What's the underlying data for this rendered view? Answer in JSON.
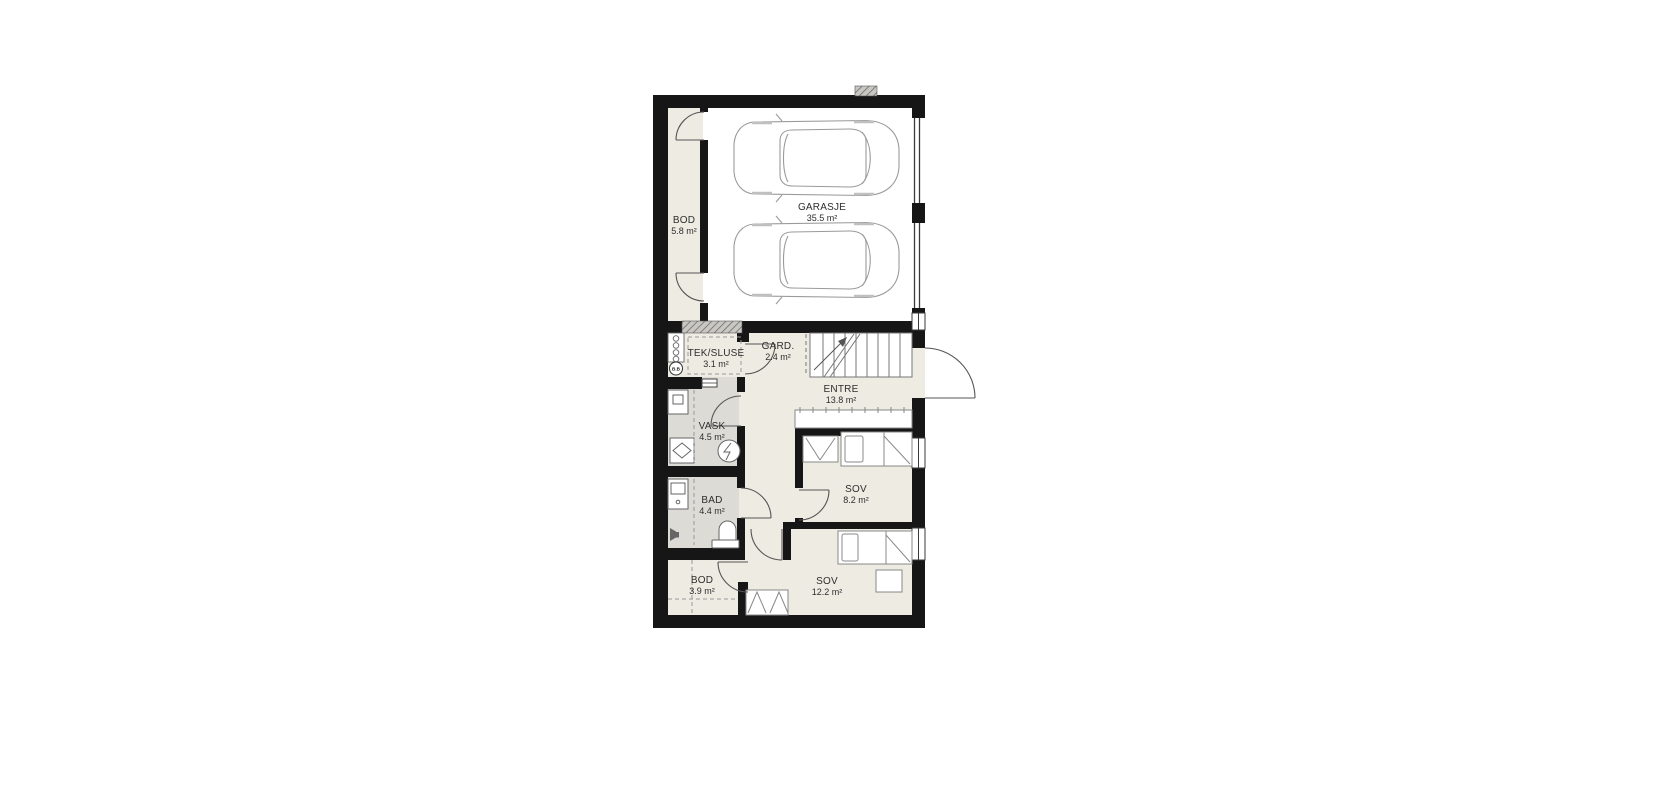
{
  "floorplan": {
    "colors": {
      "wall": "#161616",
      "floor": "#edebe2",
      "wet_room_floor": "#dcdbd6",
      "line": "#888888"
    },
    "unit": "m²",
    "rooms": [
      {
        "name": "GARASJE",
        "area": "35.5 m²"
      },
      {
        "name": "BOD",
        "area": "5.8 m²"
      },
      {
        "name": "TEK/SLUSE",
        "area": "3.1 m²"
      },
      {
        "name": "GARD.",
        "area": "2.4 m²"
      },
      {
        "name": "ENTRE",
        "area": "13.8 m²"
      },
      {
        "name": "VASK",
        "area": "4.5 m²"
      },
      {
        "name": "BAD",
        "area": "4.4 m²"
      },
      {
        "name": "SOV",
        "area": "8.2 m²"
      },
      {
        "name": "BOD",
        "area": "3.9 m²"
      },
      {
        "name": "SOV",
        "area": "12.2 m²"
      }
    ],
    "annotations": [
      {
        "label": "B.B"
      }
    ]
  }
}
